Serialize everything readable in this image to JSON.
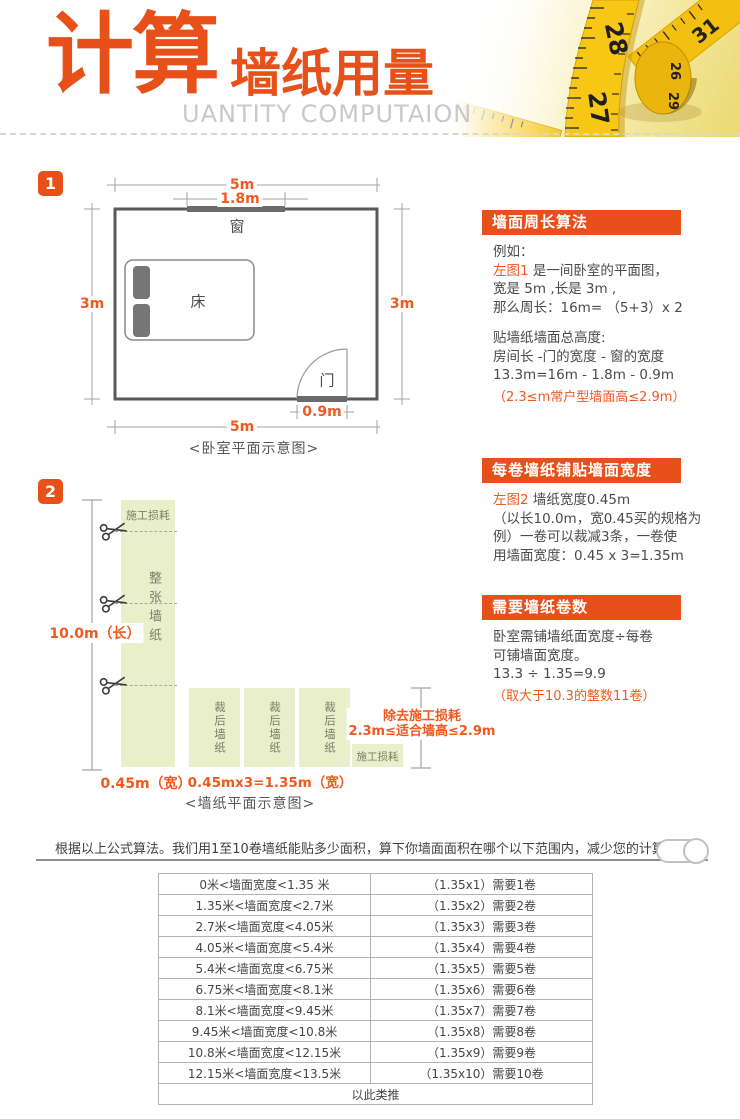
{
  "header": {
    "title_big": "计算",
    "title_small": "墙纸用量",
    "subtitle": "UANTITY COMPUTAION",
    "tape": {
      "n1": "28",
      "n2": "31",
      "n3": "26",
      "n4": "29",
      "n5": "27"
    }
  },
  "badges": {
    "one": "1",
    "two": "2"
  },
  "diagram1": {
    "dim_top": "5m",
    "dim_window": "1.8m",
    "window": "窗",
    "bed": "床",
    "door": "门",
    "dim_left": "3m",
    "dim_right": "3m",
    "dim_door": "0.9m",
    "dim_bottom": "5m",
    "caption": "<卧室平面示意图>"
  },
  "panel1": {
    "title": "墙面周长算法",
    "l1": "例如：",
    "l2a": "左图1",
    "l2b": " 是一间卧室的平面图，",
    "l3": "宽是 5m ,长是 3m ,",
    "l4": "那么周长：16m= （5+3）x 2",
    "l5": "贴墙纸墙面总高度:",
    "l6": "房间长 -门的宽度 - 窗的宽度",
    "l7": "13.3m=16m - 1.8m - 0.9m",
    "note": "（2.3≤m常户型墙面高≤2.9m）"
  },
  "diagram2": {
    "waste_top": "施工损耗",
    "full_roll": "整张墙纸",
    "length": "10.0m（长）",
    "width": "0.45m（宽）",
    "cut_strip": "裁后墙纸",
    "waste_box": "施工损耗",
    "dim_bottom": "0.45mx3=1.35m（宽）",
    "note1": "除去施工损耗",
    "note2": "2.3m≤适合墙高≤2.9m",
    "caption": "<墙纸平面示意图>"
  },
  "panel2": {
    "title": "每卷墙纸铺贴墙面宽度",
    "l1a": "左图2",
    "l1b": " 墙纸宽度0.45m",
    "l2": "（以长10.0m，宽0.45买的规格为",
    "l3": "例）一卷可以裁减3条，一卷使",
    "l4": "用墙面宽度：0.45 x 3=1.35m"
  },
  "panel3": {
    "title": "需要墙纸卷数",
    "l1": "卧室需铺墙纸面宽度÷每卷",
    "l2": "可铺墙面宽度。",
    "l3": "13.3 ÷ 1.35=9.9",
    "note": "（取大于10.3的整数11卷）"
  },
  "divider": {
    "intro": "根据以上公式算法。我们用1至10卷墙纸能贴多少面积，算下你墙面面积在哪个以下范围内，减少您的计算时间"
  },
  "table": {
    "rows": [
      [
        "0米<墙面宽度<1.35 米",
        "（1.35x1）需要1卷"
      ],
      [
        "1.35米<墙面宽度<2.7米",
        "（1.35x2）需要2卷"
      ],
      [
        "2.7米<墙面宽度<4.05米",
        "（1.35x3）需要3卷"
      ],
      [
        "4.05米<墙面宽度<5.4米",
        "（1.35x4）需要4卷"
      ],
      [
        "5.4米<墙面宽度<6.75米",
        "（1.35x5）需要5卷"
      ],
      [
        "6.75米<墙面宽度<8.1米",
        "（1.35x6）需要6卷"
      ],
      [
        "8.1米<墙面宽度<9.45米",
        "（1.35x7）需要7卷"
      ],
      [
        "9.45米<墙面宽度<10.8米",
        "（1.35x8）需要8卷"
      ],
      [
        "10.8米<墙面宽度<12.15米",
        "（1.35x9）需要9卷"
      ],
      [
        "12.15米<墙面宽度<13.5米",
        "（1.35x10）需要10卷"
      ]
    ],
    "footer": "以此类推"
  },
  "colors": {
    "accent": "#e8501a",
    "accent_text": "#f2591f",
    "strip_green": "#e9efca",
    "tape_yellow": "#f5c411"
  }
}
